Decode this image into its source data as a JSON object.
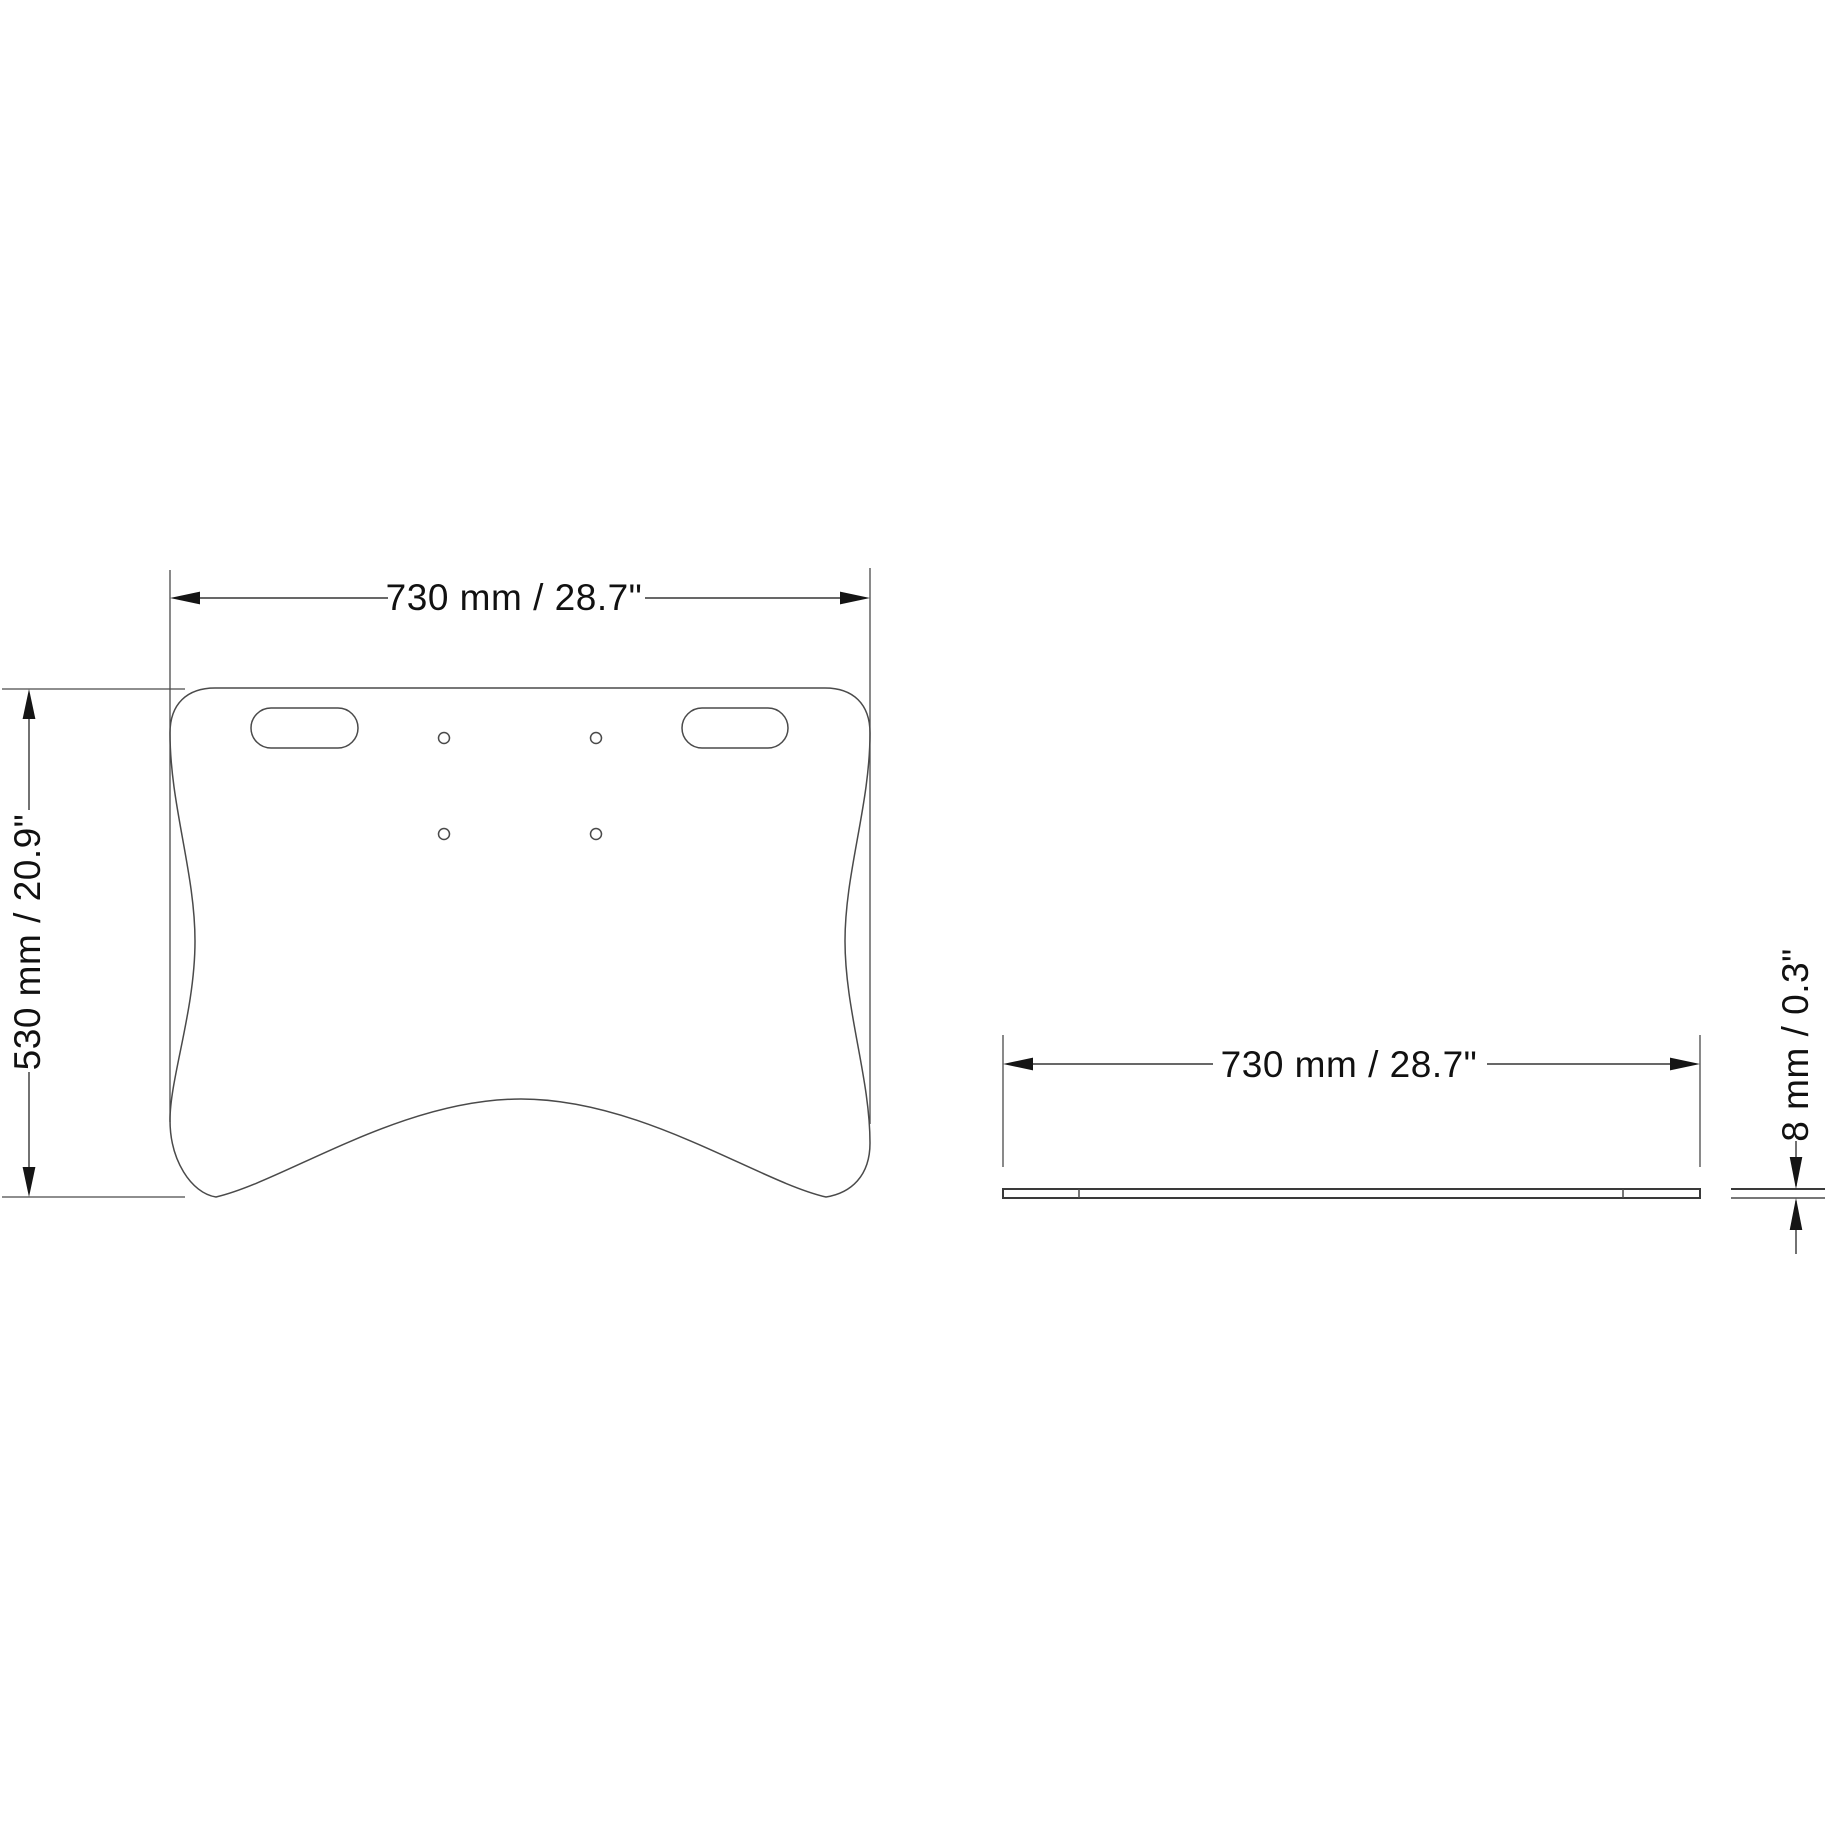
{
  "drawing": {
    "type": "technical-dimension-drawing",
    "subject": "desk plate / tabletop panel",
    "views": {
      "top": {
        "name": "top-view",
        "width_label": "730 mm / 28.7\"",
        "depth_label": "530 mm / 20.9\""
      },
      "side": {
        "name": "side-view",
        "width_label": "730 mm / 28.7\"",
        "thickness_label": "8 mm / 0.3\""
      }
    },
    "dimensions": {
      "width_mm": 730,
      "width_in": 28.7,
      "depth_mm": 530,
      "depth_in": 20.9,
      "thickness_mm": 8,
      "thickness_in": 0.3
    },
    "features": {
      "handle_slots": 2,
      "mounting_holes": 4
    },
    "colors": {
      "background": "#ffffff",
      "geometry_line": "#4a4a4a",
      "dimension_line": "#363636",
      "arrow": "#151515",
      "text": "#111111"
    }
  }
}
